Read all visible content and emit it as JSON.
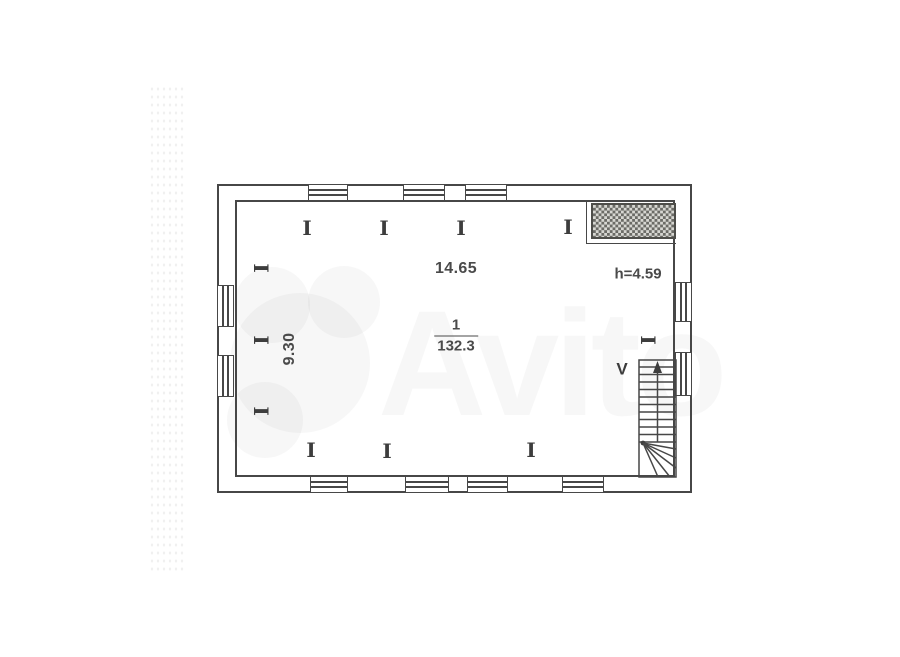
{
  "canvas": {
    "width": 900,
    "height": 657,
    "background": "#ffffff"
  },
  "plan": {
    "room": {
      "number": "1",
      "area": "132.3"
    },
    "labels": {
      "width": "14.65",
      "depth": "9.30",
      "ceiling_height": "h=4.59",
      "stair_mark": "V"
    },
    "column_glyph": "I",
    "watermark": {
      "text": "Avito"
    }
  },
  "colors": {
    "line": "#474747",
    "text": "#4a4a4a",
    "hatch_dark": "#6b6b66",
    "hatch_light": "#d7d7d2",
    "watermark": "rgba(118,118,108,0.055)"
  },
  "geometry": {
    "outer": {
      "x": 217,
      "y": 184,
      "w": 475,
      "h": 309
    },
    "wall": 17,
    "windows": {
      "top": [
        [
          308,
          348
        ],
        [
          403,
          445
        ],
        [
          465,
          507
        ]
      ],
      "bottom": [
        [
          310,
          348
        ],
        [
          405,
          449
        ],
        [
          467,
          508
        ],
        [
          562,
          604
        ]
      ],
      "left": [
        [
          285,
          327
        ],
        [
          355,
          397
        ]
      ],
      "right": [
        [
          282,
          322
        ],
        [
          352,
          396
        ]
      ]
    },
    "columns": {
      "top": [
        [
          307,
          228
        ],
        [
          384,
          228
        ],
        [
          461,
          228
        ],
        [
          568,
          227
        ]
      ],
      "bottom": [
        [
          311,
          450
        ],
        [
          387,
          451
        ],
        [
          531,
          450
        ]
      ],
      "left": [
        [
          261,
          268
        ],
        [
          261,
          340
        ],
        [
          261,
          411
        ]
      ],
      "right": [
        [
          648,
          340
        ]
      ]
    }
  }
}
